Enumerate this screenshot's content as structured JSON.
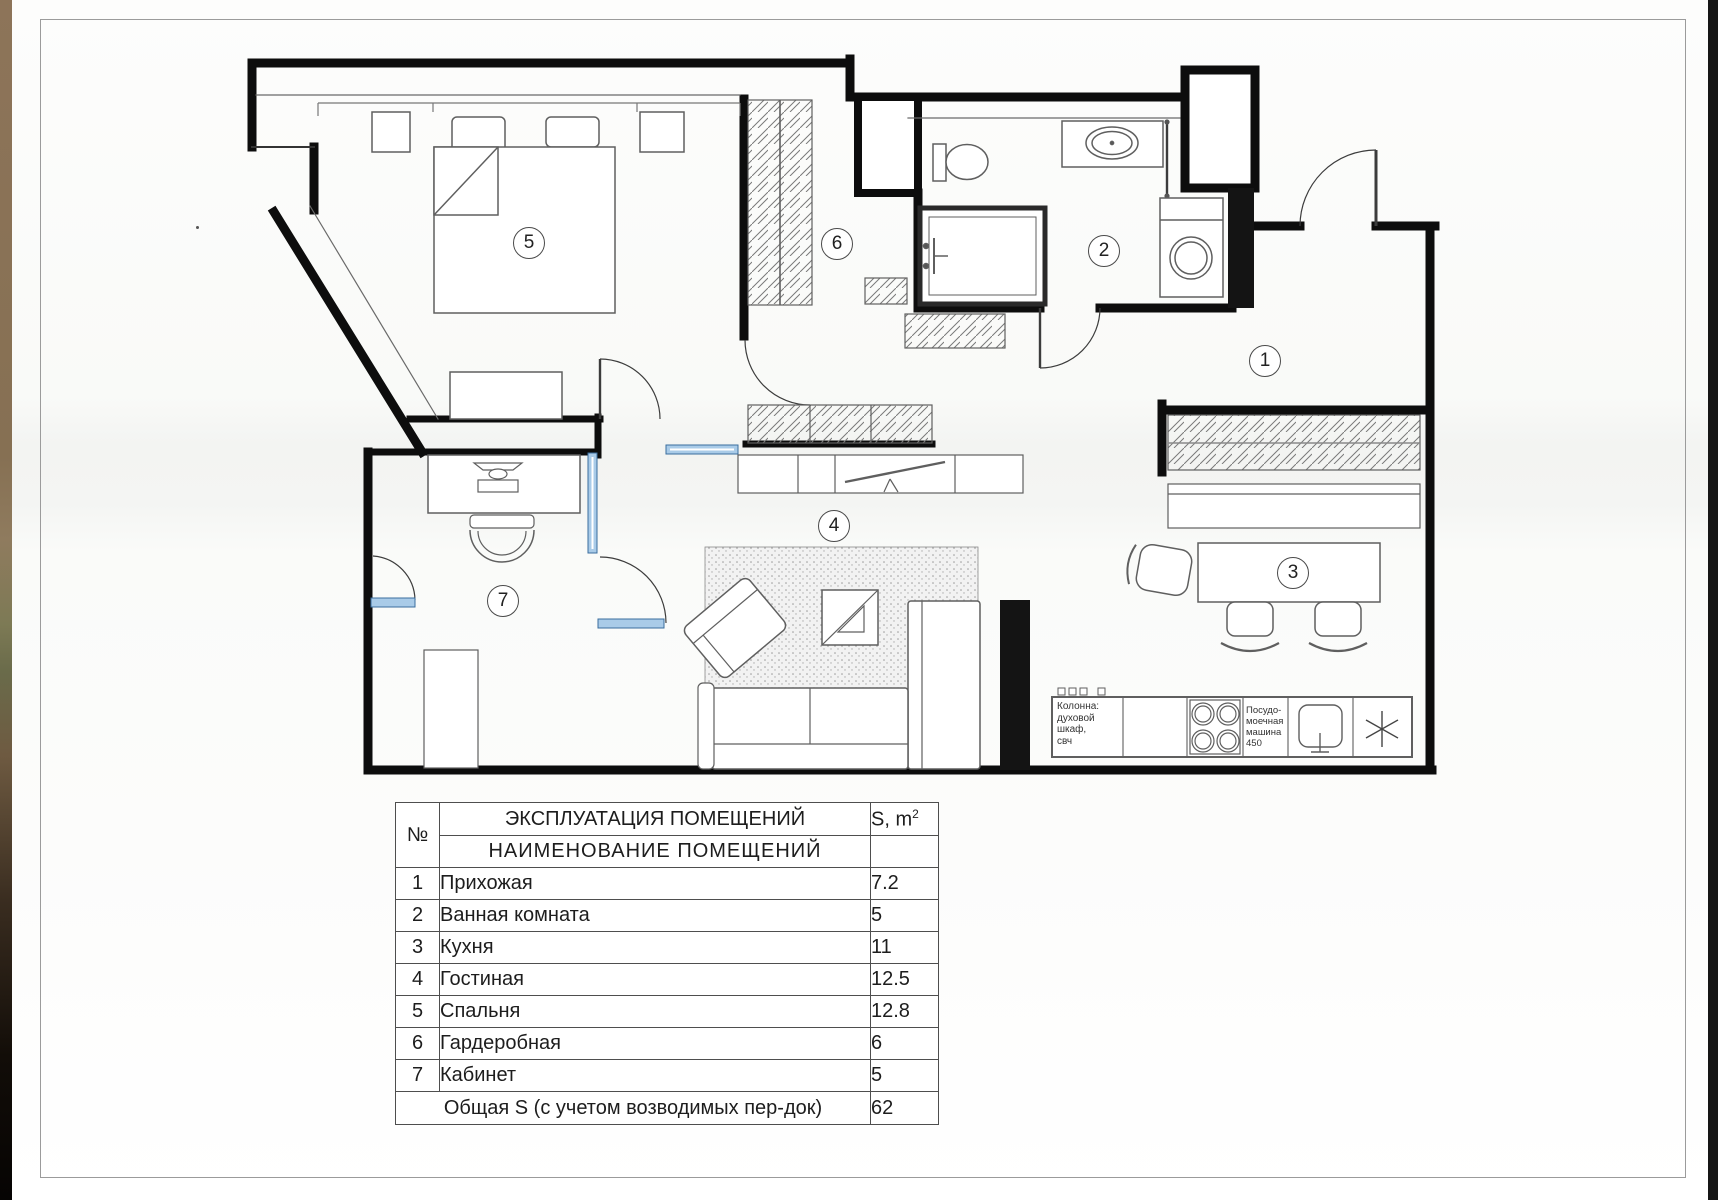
{
  "plan": {
    "room_numbers": {
      "r1": "1",
      "r2": "2",
      "r3": "3",
      "r4": "4",
      "r5": "5",
      "r6": "6",
      "r7": "7"
    },
    "annotations": {
      "column_text": "Колонна:\nдуховой\nшкаф,\nсвч",
      "dishwasher_text": "Посудо-\nмоечная\nмашина\n450"
    }
  },
  "table": {
    "title": "ЭКСПЛУАТАЦИЯ ПОМЕЩЕНИЙ",
    "number_header": "№",
    "name_header": "НАИМЕНОВАНИЕ ПОМЕЩЕНИЙ",
    "area_header_base": "S, m",
    "area_header_sup": "2",
    "rows": [
      {
        "num": "1",
        "name": "Прихожая",
        "area": "7.2"
      },
      {
        "num": "2",
        "name": "Ванная комната",
        "area": "5"
      },
      {
        "num": "3",
        "name": "Кухня",
        "area": "11"
      },
      {
        "num": "4",
        "name": "Гостиная",
        "area": "12.5"
      },
      {
        "num": "5",
        "name": "Спальня",
        "area": "12.8"
      },
      {
        "num": "6",
        "name": "Гардеробная",
        "area": "6"
      },
      {
        "num": "7",
        "name": "Кабинет",
        "area": "5"
      }
    ],
    "total_label": "Общая S (с учетом возводимых пер-док)",
    "total_value": "62"
  },
  "colors": {
    "wall": "#0d0d0d",
    "glass_fill": "#a9cbe8",
    "glass_stroke": "#3a6e9e"
  }
}
